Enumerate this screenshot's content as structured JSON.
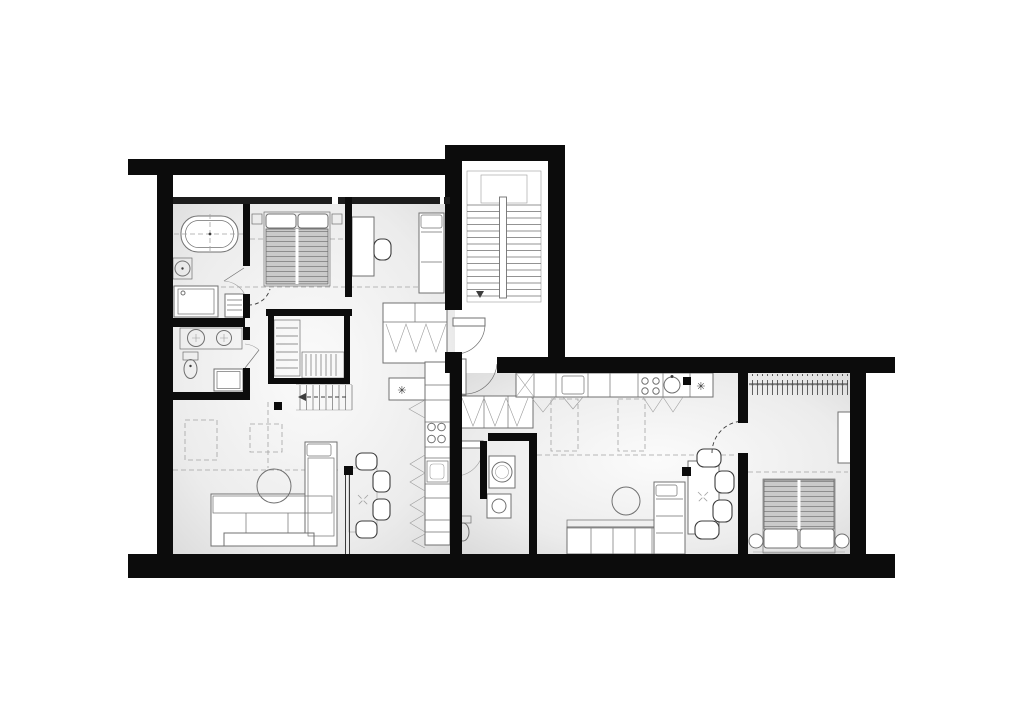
{
  "plan": {
    "kind": "residential floor plan, top-down black and white architectural drawing",
    "units": [
      {
        "name": "left-unit",
        "rooms": [
          "bathroom",
          "shower-room",
          "bedroom",
          "study-bedroom",
          "walk-in-closet",
          "hallway",
          "kitchen",
          "living-dining-room"
        ],
        "furniture": [
          "bathtub",
          "washbasin",
          "shower",
          "towel-ladder",
          "double-vanity",
          "toilet",
          "double-bed",
          "desk",
          "desk-chair",
          "single-bed",
          "shelving",
          "dresser",
          "internal-stair",
          "fridge",
          "kitchen-cabinets",
          "hob",
          "kitchen-sink",
          "corner-sofa",
          "coffee-table",
          "dining-table",
          "dining-chairs"
        ]
      },
      {
        "name": "right-unit",
        "rooms": [
          "entry-hall",
          "wc-laundry",
          "kitchen",
          "living-dining-room",
          "bedroom"
        ],
        "furniture": [
          "hall-wardrobe",
          "washing-machine",
          "washbasin",
          "toilet",
          "kitchen-counter",
          "dishwasher",
          "hob",
          "round-sink",
          "fridge",
          "corner-sofa",
          "coffee-table",
          "dining-table",
          "dining-chairs",
          "clothes-rail",
          "desk",
          "double-bed",
          "bedside-tables"
        ]
      }
    ],
    "shared": [
      "main-staircase",
      "stair-landing",
      "entry-doors"
    ]
  },
  "symbols": {
    "fridge_freezer": "✳"
  },
  "colors": {
    "bg": "#ffffff",
    "wall": "#0c0c0c",
    "wall_thin": "#1c1c1c",
    "line": "#707070",
    "line_dark": "#3c3c3c",
    "line_light": "#9c9c9c",
    "dash_color": "#a3a3a3",
    "floor_center": "#fbfbfb",
    "floor_mid": "#ececec",
    "floor_edge": "#d6d6d6",
    "duvet_base": "#cacaca",
    "duvet_stripe": "#8e8e8e"
  }
}
